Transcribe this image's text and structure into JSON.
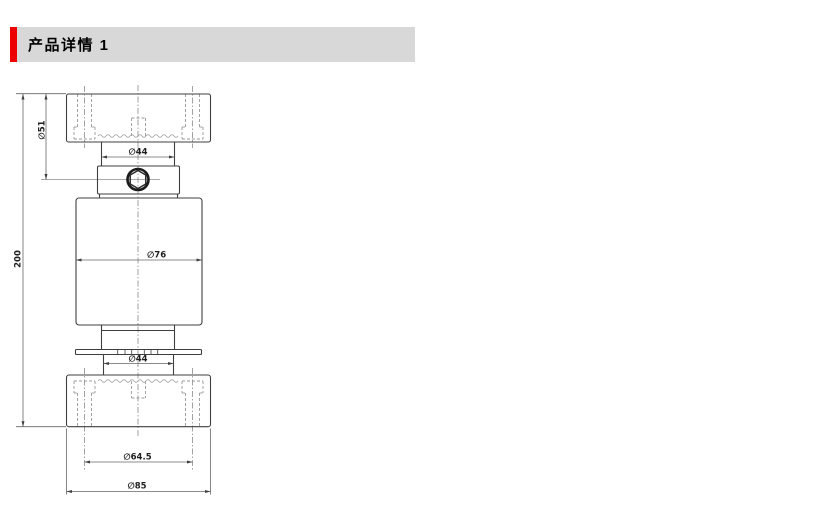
{
  "header": {
    "title": "产品详情 1",
    "accent_color": "#ec0000",
    "band_color": "#d8d8d8"
  },
  "drawing": {
    "dimensions": {
      "total_height": "200",
      "upper_boss": "∅51",
      "upper_neck": "∅44",
      "body": "∅76",
      "lower_neck": "∅44",
      "bolt_circle": "∅64.5",
      "end_cap": "∅85"
    }
  }
}
